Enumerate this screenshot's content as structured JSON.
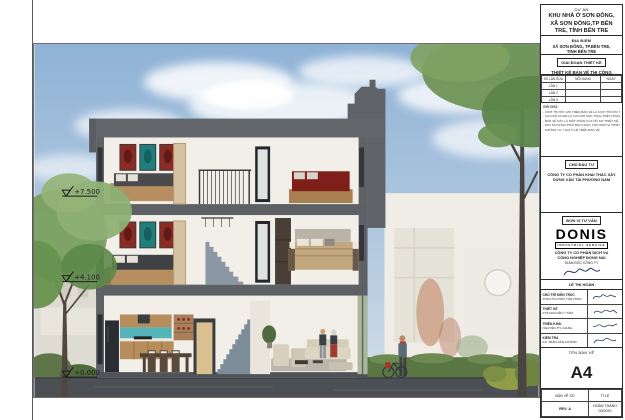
{
  "title_block": {
    "project_label": "DỰ ÁN",
    "project_name_l1": "KHU NHÀ Ở SƠN ĐÔNG,",
    "project_name_l2": "XÃ SƠN ĐÔNG,TP BẾN",
    "project_name_l3": "TRE, TỈNH BẾN TRE",
    "location_label": "ĐỊA ĐIỂM",
    "location_l1": "XÃ SƠN ĐÔNG, TP.BẾN TRE,",
    "location_l2": "TỈNH BẾN TRE",
    "phase_label": "GIAI ĐOẠN THIẾT KẾ",
    "phase_name": "THIẾT KẾ BẢN VẼ THI CÔNG",
    "revision_table": {
      "headers": [
        "SỐ LẦN SỬA",
        "NỘI DUNG",
        "NGÀY"
      ],
      "rows": [
        "LẦN 1",
        "LẦN 2",
        "LẦN 3"
      ]
    },
    "notes_label": "GHI CHÚ:",
    "notes": [
      "- KÍCH THƯỚC GHI TRÊN BẢN VẼ LÀ KÍCH THƯỚC THÔNG THỦY THEO MM.",
      "- CAO ĐỘ ±0.000 LÀ CAO ĐỘ SÀN TẦNG TRỆT HOÀN THIỆN.",
      "- BẢN VẼ NÀY LÀ MỘT PHẦN CỦA HỒ SƠ THIẾT KẾ, KHÔNG TÁCH RỜI.",
      "- MỌI SAI KHÁC PHẢI BÁO NGAY CHO ĐƠN VỊ THIẾT KẾ ĐỂ XỬ LÝ.",
      "- KHÔNG TỰ Ý ĐO TỈ LỆ TRÊN BẢN VẼ."
    ],
    "investor_label": "CHỦ ĐẦU TƯ",
    "investor_l1": "CÔNG TY CỔ PHẦN KHAI THÁC  XÂY",
    "investor_l2": "DỰNG VẬN TẢI PHƯƠNG NAM",
    "consultant_label": "ĐƠN VỊ TƯ VẤN",
    "logo_name": "DONIS",
    "logo_tagline": "INDUSTRIAL  SERVICE",
    "consultant_l1": "CÔNG TY CỔ PHẦN DỊCH VỤ",
    "consultant_l2": "CÔNG NGHIỆP ĐỒNG NAI",
    "director_label": "GIÁM ĐỐC CÔNG TY",
    "director_name": "LÊ THỊ HOÀN",
    "roles": [
      {
        "role": "CHỦ TRÌ KIẾN TRÚC",
        "name": "THS.KTS CHÂU TẤN THẢO"
      },
      {
        "role": "THIẾT KẾ",
        "name": "KTS.NGUYỄN Ý TÂM"
      },
      {
        "role": "TRIỂN KHAI",
        "name": "NGUYỄN TH. GIANG"
      },
      {
        "role": "KIỂM TRA",
        "name": "KS. TRẦN VĂN CƯỜNG"
      }
    ],
    "drawing_name_label": "TÊN BẢN VẼ",
    "sheet_size": "A4",
    "drawing_no_label": "BẢN VẼ SỐ",
    "scale_label": "TỈ LỆ",
    "rev_value": "REV: A",
    "completion_l1": "HOÀN THÀNH",
    "completion_l2": "09/2020"
  },
  "drawing": {
    "elevations": [
      {
        "label": "+7.500"
      },
      {
        "label": "+4.100"
      },
      {
        "label": "+0.000"
      }
    ]
  },
  "colors": {
    "sky_top": "#8fb2d6",
    "sky_bottom": "#d6e0ea",
    "cut_wall": "#63676b",
    "interior": "#f2efe8",
    "road": "#4c4f53",
    "hedge": "#5a7743",
    "tree": "#76a05e",
    "backsplash": "#55b3ba",
    "art_red": "#8c2b24",
    "art_teal": "#1f7f7c",
    "bed_maroon": "#7e1f1a"
  }
}
